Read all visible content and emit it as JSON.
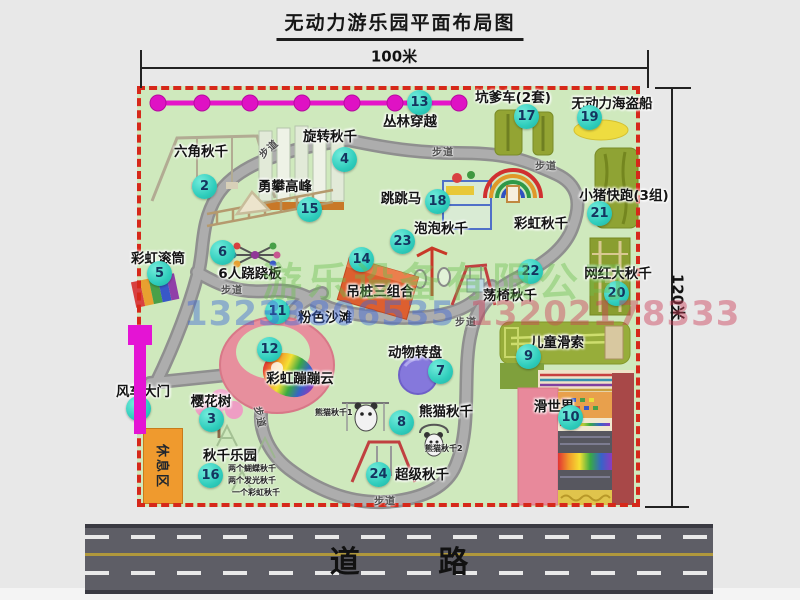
{
  "title": "无动力游乐园平面布局图",
  "dimensions": {
    "width_label": "100米",
    "height_label": "120米"
  },
  "road": {
    "label": "道 路"
  },
  "watermark": {
    "company": "游乐设备有限公司",
    "phone1": "13233806535",
    "phone2": "13202178333"
  },
  "path_label": "步道",
  "rest_area_label": "休息区",
  "rainbow_swing": {
    "label": "彩虹秋千"
  },
  "attractions": [
    {
      "num": "1",
      "label": "风车大门"
    },
    {
      "num": "2",
      "label": "六角秋千"
    },
    {
      "num": "3",
      "label": "樱花树"
    },
    {
      "num": "4",
      "label": "旋转秋千"
    },
    {
      "num": "5",
      "label": "彩虹滚筒"
    },
    {
      "num": "6",
      "label": "6人跷跷板"
    },
    {
      "num": "7",
      "label": "动物转盘"
    },
    {
      "num": "8",
      "label": "熊猫秋千",
      "notes": [
        "熊猫秋千1",
        "熊猫秋千2"
      ]
    },
    {
      "num": "9",
      "label": "儿童滑索"
    },
    {
      "num": "10",
      "label": "滑世界"
    },
    {
      "num": "11",
      "label": "粉色沙滩"
    },
    {
      "num": "12",
      "label": "彩虹蹦蹦云"
    },
    {
      "num": "13",
      "label": "丛林穿越"
    },
    {
      "num": "14",
      "label": "吊桩三组合"
    },
    {
      "num": "15",
      "label": "勇攀高峰"
    },
    {
      "num": "16",
      "label": "秋千乐园",
      "notes": [
        "两个蝴蝶秋千",
        "两个发光秋千",
        "一个彩虹秋千"
      ]
    },
    {
      "num": "17",
      "label": "坑爹车(2套)"
    },
    {
      "num": "18",
      "label": "跳跳马"
    },
    {
      "num": "19",
      "label": "无动力海盗船"
    },
    {
      "num": "20",
      "label": "网红大秋千"
    },
    {
      "num": "21",
      "label": "小猪快跑(3组)"
    },
    {
      "num": "22",
      "label": "荡椅秋千"
    },
    {
      "num": "23",
      "label": "泡泡秋千"
    },
    {
      "num": "24",
      "label": "超级秋千"
    }
  ],
  "colors": {
    "map_green": "#cfe9bd",
    "border_red": "#d6281a",
    "badge_teal": "#2fcdbc",
    "zipline_magenta": "#e515c9",
    "gate_magenta": "#e414d4",
    "rest_orange": "#ef9a2e",
    "road_gray": "#5e5e66",
    "path_gray": "#9a9a9a"
  }
}
